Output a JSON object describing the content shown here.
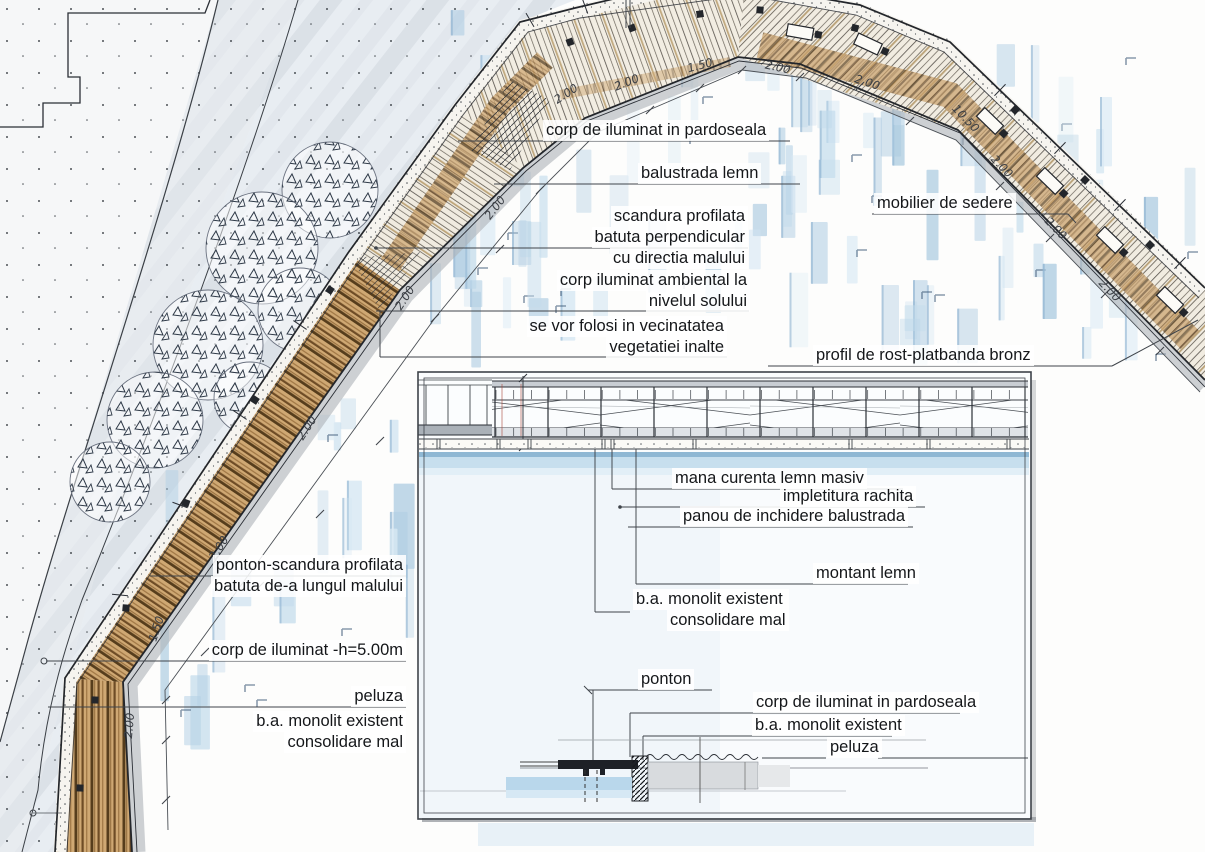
{
  "drawing": {
    "kind": "waterfront promenade plan and section sketch",
    "colors": {
      "ink": "#2b2f36",
      "leader": "#3f444a",
      "wood": "#a87c4a",
      "water_wash": "#bcd6e8",
      "shore_wash": "#dfe5ec",
      "paper": "#ffffff"
    }
  },
  "labels": {
    "corp_pardoseala": "corp de iluminat in pardoseala",
    "balustrada": "balustrada lemn",
    "scandura1": "scandura profilata",
    "scandura2": "batuta perpendicular",
    "scandura3": "cu directia malului",
    "mobilier": "mobilier de sedere",
    "ambiental1": "corp iluminat ambiental la",
    "ambiental2": "nivelul solului",
    "vecinatate1": "se vor folosi in vecinatatea",
    "vecinatate2": "vegetatiei inalte",
    "profil_rost": "profil de rost-platbanda bronz",
    "mana_curenta": "mana curenta lemn masiv",
    "impletitura": "impletitura rachita",
    "panou": "panou de inchidere balustrada",
    "montant": "montant lemn",
    "ba_monolit_a1": "b.a. monolit existent",
    "ba_monolit_a2": "consolidare mal",
    "ponton": "ponton",
    "corp_pardoseala2": "corp de iluminat in pardoseala",
    "ba_monolit_b": "b.a. monolit existent",
    "peluza_sectiune": "peluza",
    "ponton_scandura1": "ponton-scandura profilata",
    "ponton_scandura2": "batuta de-a lungul malului",
    "corp_h500": "corp de iluminat -h=5.00m",
    "peluza_plan": "peluza",
    "ba_monolit_c1": "b.a. monolit existent",
    "ba_monolit_c2": "consolidare mal"
  },
  "dims": [
    "2.00",
    "1.50",
    "2.00",
    "2.00",
    "2.00",
    "2.00",
    "2.00",
    "2.00",
    "1.50",
    "2.00",
    "2.00",
    "10.50",
    "2.00",
    "2.00",
    "2.00"
  ]
}
